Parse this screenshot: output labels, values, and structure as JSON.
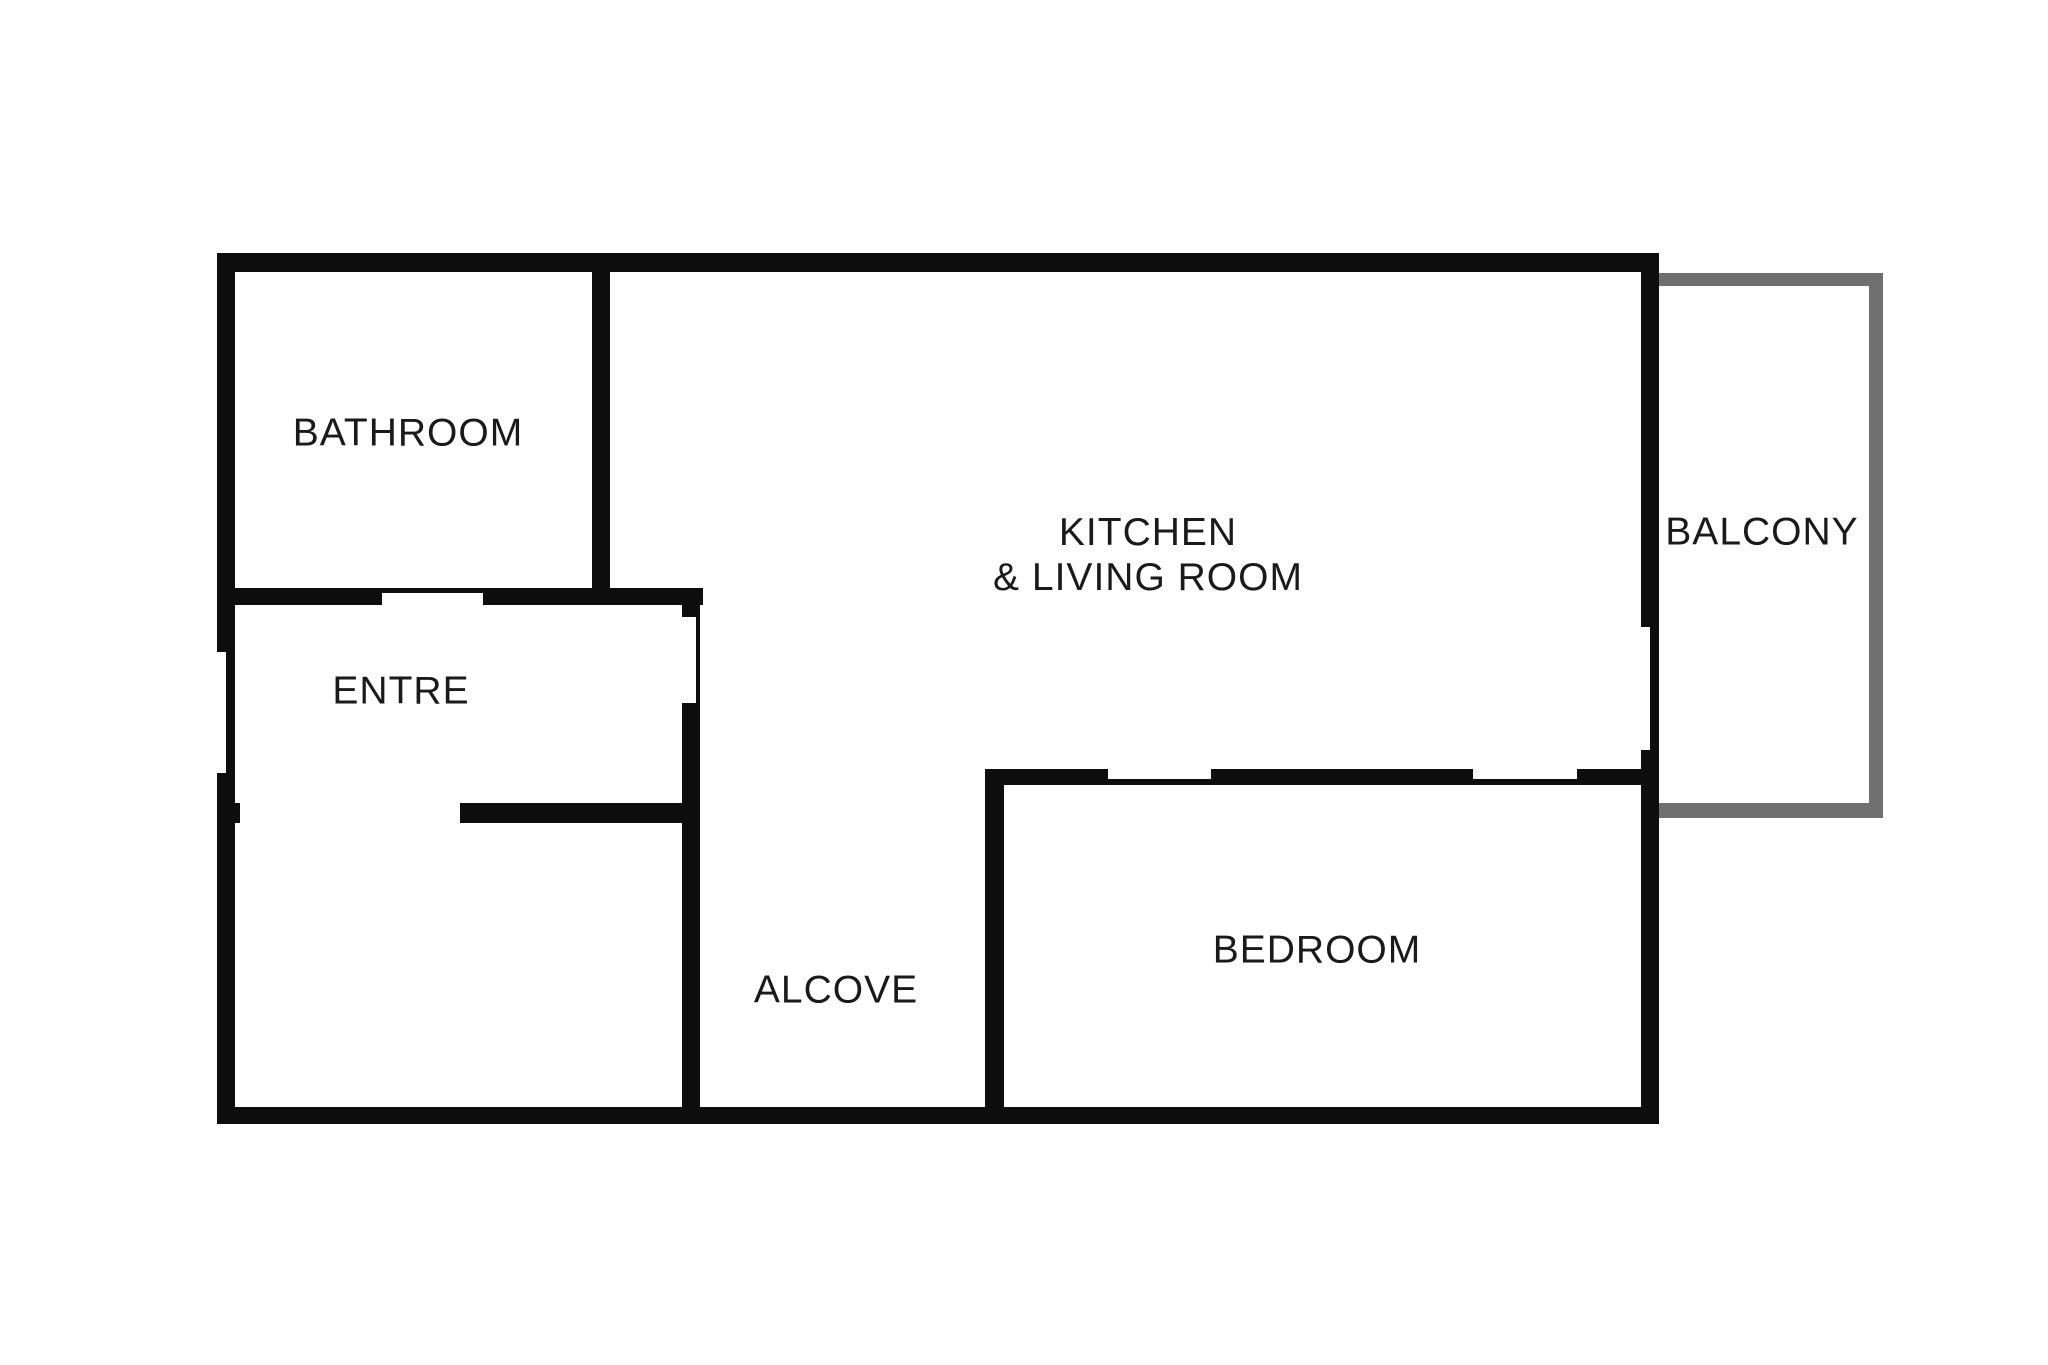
{
  "title": "Apartment floor plan",
  "canvas": {
    "width": 2048,
    "height": 1365,
    "background": "#ffffff"
  },
  "colors": {
    "wall": "#0d0d0d",
    "balcony_wall": "#6f6f6f",
    "label": "#1a1a1a"
  },
  "rooms": [
    {
      "id": "bathroom",
      "lines": [
        "BATHROOM"
      ],
      "cx": 408,
      "cy": 433
    },
    {
      "id": "entre",
      "lines": [
        "ENTRE"
      ],
      "cx": 401,
      "cy": 691
    },
    {
      "id": "kitchen-living-room",
      "lines": [
        "KITCHEN",
        "& LIVING ROOM"
      ],
      "cx": 1148,
      "cy": 555
    },
    {
      "id": "balcony",
      "lines": [
        "BALCONY"
      ],
      "cx": 1762,
      "cy": 532
    },
    {
      "id": "alcove",
      "lines": [
        "ALCOVE"
      ],
      "cx": 836,
      "cy": 990
    },
    {
      "id": "bedroom",
      "lines": [
        "BEDROOM"
      ],
      "cx": 1317,
      "cy": 950
    }
  ],
  "walls": [
    {
      "name": "exterior-north-wall",
      "type": "wall",
      "x": 217,
      "y": 253,
      "w": 1442,
      "h": 19
    },
    {
      "name": "exterior-south-wall",
      "type": "wall",
      "x": 217,
      "y": 1107,
      "w": 1442,
      "h": 17
    },
    {
      "name": "exterior-west-wall-upper",
      "type": "wall",
      "x": 217,
      "y": 253,
      "w": 18,
      "h": 399
    },
    {
      "name": "exterior-west-wall-entry-thin",
      "type": "wall",
      "x": 226,
      "y": 652,
      "w": 9,
      "h": 121
    },
    {
      "name": "exterior-west-wall-lower",
      "type": "wall",
      "x": 217,
      "y": 773,
      "w": 18,
      "h": 351
    },
    {
      "name": "exterior-east-wall-upper",
      "type": "wall",
      "x": 1641,
      "y": 253,
      "w": 18,
      "h": 374
    },
    {
      "name": "exterior-east-wall-balcony-door",
      "type": "wall",
      "x": 1650,
      "y": 627,
      "w": 9,
      "h": 123
    },
    {
      "name": "exterior-east-wall-lower",
      "type": "wall",
      "x": 1641,
      "y": 750,
      "w": 18,
      "h": 374
    },
    {
      "name": "bathroom-east-wall",
      "type": "wall",
      "x": 592,
      "y": 272,
      "w": 18,
      "h": 333
    },
    {
      "name": "bathroom-south-wall-west",
      "type": "wall",
      "x": 235,
      "y": 588,
      "w": 147,
      "h": 17
    },
    {
      "name": "bathroom-door-sill",
      "type": "wall",
      "x": 382,
      "y": 588,
      "w": 101,
      "h": 5
    },
    {
      "name": "bathroom-south-wall-east",
      "type": "wall",
      "x": 483,
      "y": 588,
      "w": 220,
      "h": 17
    },
    {
      "name": "entre-east-wall-stub",
      "type": "wall",
      "x": 682,
      "y": 605,
      "w": 18,
      "h": 12
    },
    {
      "name": "entre-door-sill",
      "type": "wall",
      "x": 696,
      "y": 617,
      "w": 4,
      "h": 86
    },
    {
      "name": "entre-east-wall-lower",
      "type": "wall",
      "x": 682,
      "y": 703,
      "w": 18,
      "h": 404
    },
    {
      "name": "entre-south-wall-nub",
      "type": "wall",
      "x": 235,
      "y": 803,
      "w": 5,
      "h": 20
    },
    {
      "name": "entre-south-wall",
      "type": "wall",
      "x": 460,
      "y": 803,
      "w": 240,
      "h": 20
    },
    {
      "name": "kitchen-bedroom-divider-west",
      "type": "wall",
      "x": 985,
      "y": 769,
      "w": 123,
      "h": 16
    },
    {
      "name": "kitchen-bedroom-divider-mid",
      "type": "wall",
      "x": 1211,
      "y": 769,
      "w": 262,
      "h": 16
    },
    {
      "name": "kitchen-bedroom-divider-east",
      "type": "wall",
      "x": 1577,
      "y": 769,
      "w": 82,
      "h": 16
    },
    {
      "name": "bedroom-door-sill-west",
      "type": "wall",
      "x": 1108,
      "y": 779,
      "w": 103,
      "h": 6
    },
    {
      "name": "bedroom-door-sill-east",
      "type": "wall",
      "x": 1473,
      "y": 779,
      "w": 104,
      "h": 6
    },
    {
      "name": "bedroom-west-wall",
      "type": "wall",
      "x": 985,
      "y": 769,
      "w": 19,
      "h": 338
    },
    {
      "name": "balcony-north-wall",
      "type": "balcony",
      "x": 1659,
      "y": 273,
      "w": 224,
      "h": 13
    },
    {
      "name": "balcony-east-wall",
      "type": "balcony",
      "x": 1869,
      "y": 273,
      "w": 14,
      "h": 545
    },
    {
      "name": "balcony-south-wall",
      "type": "balcony",
      "x": 1659,
      "y": 803,
      "w": 224,
      "h": 15
    }
  ]
}
